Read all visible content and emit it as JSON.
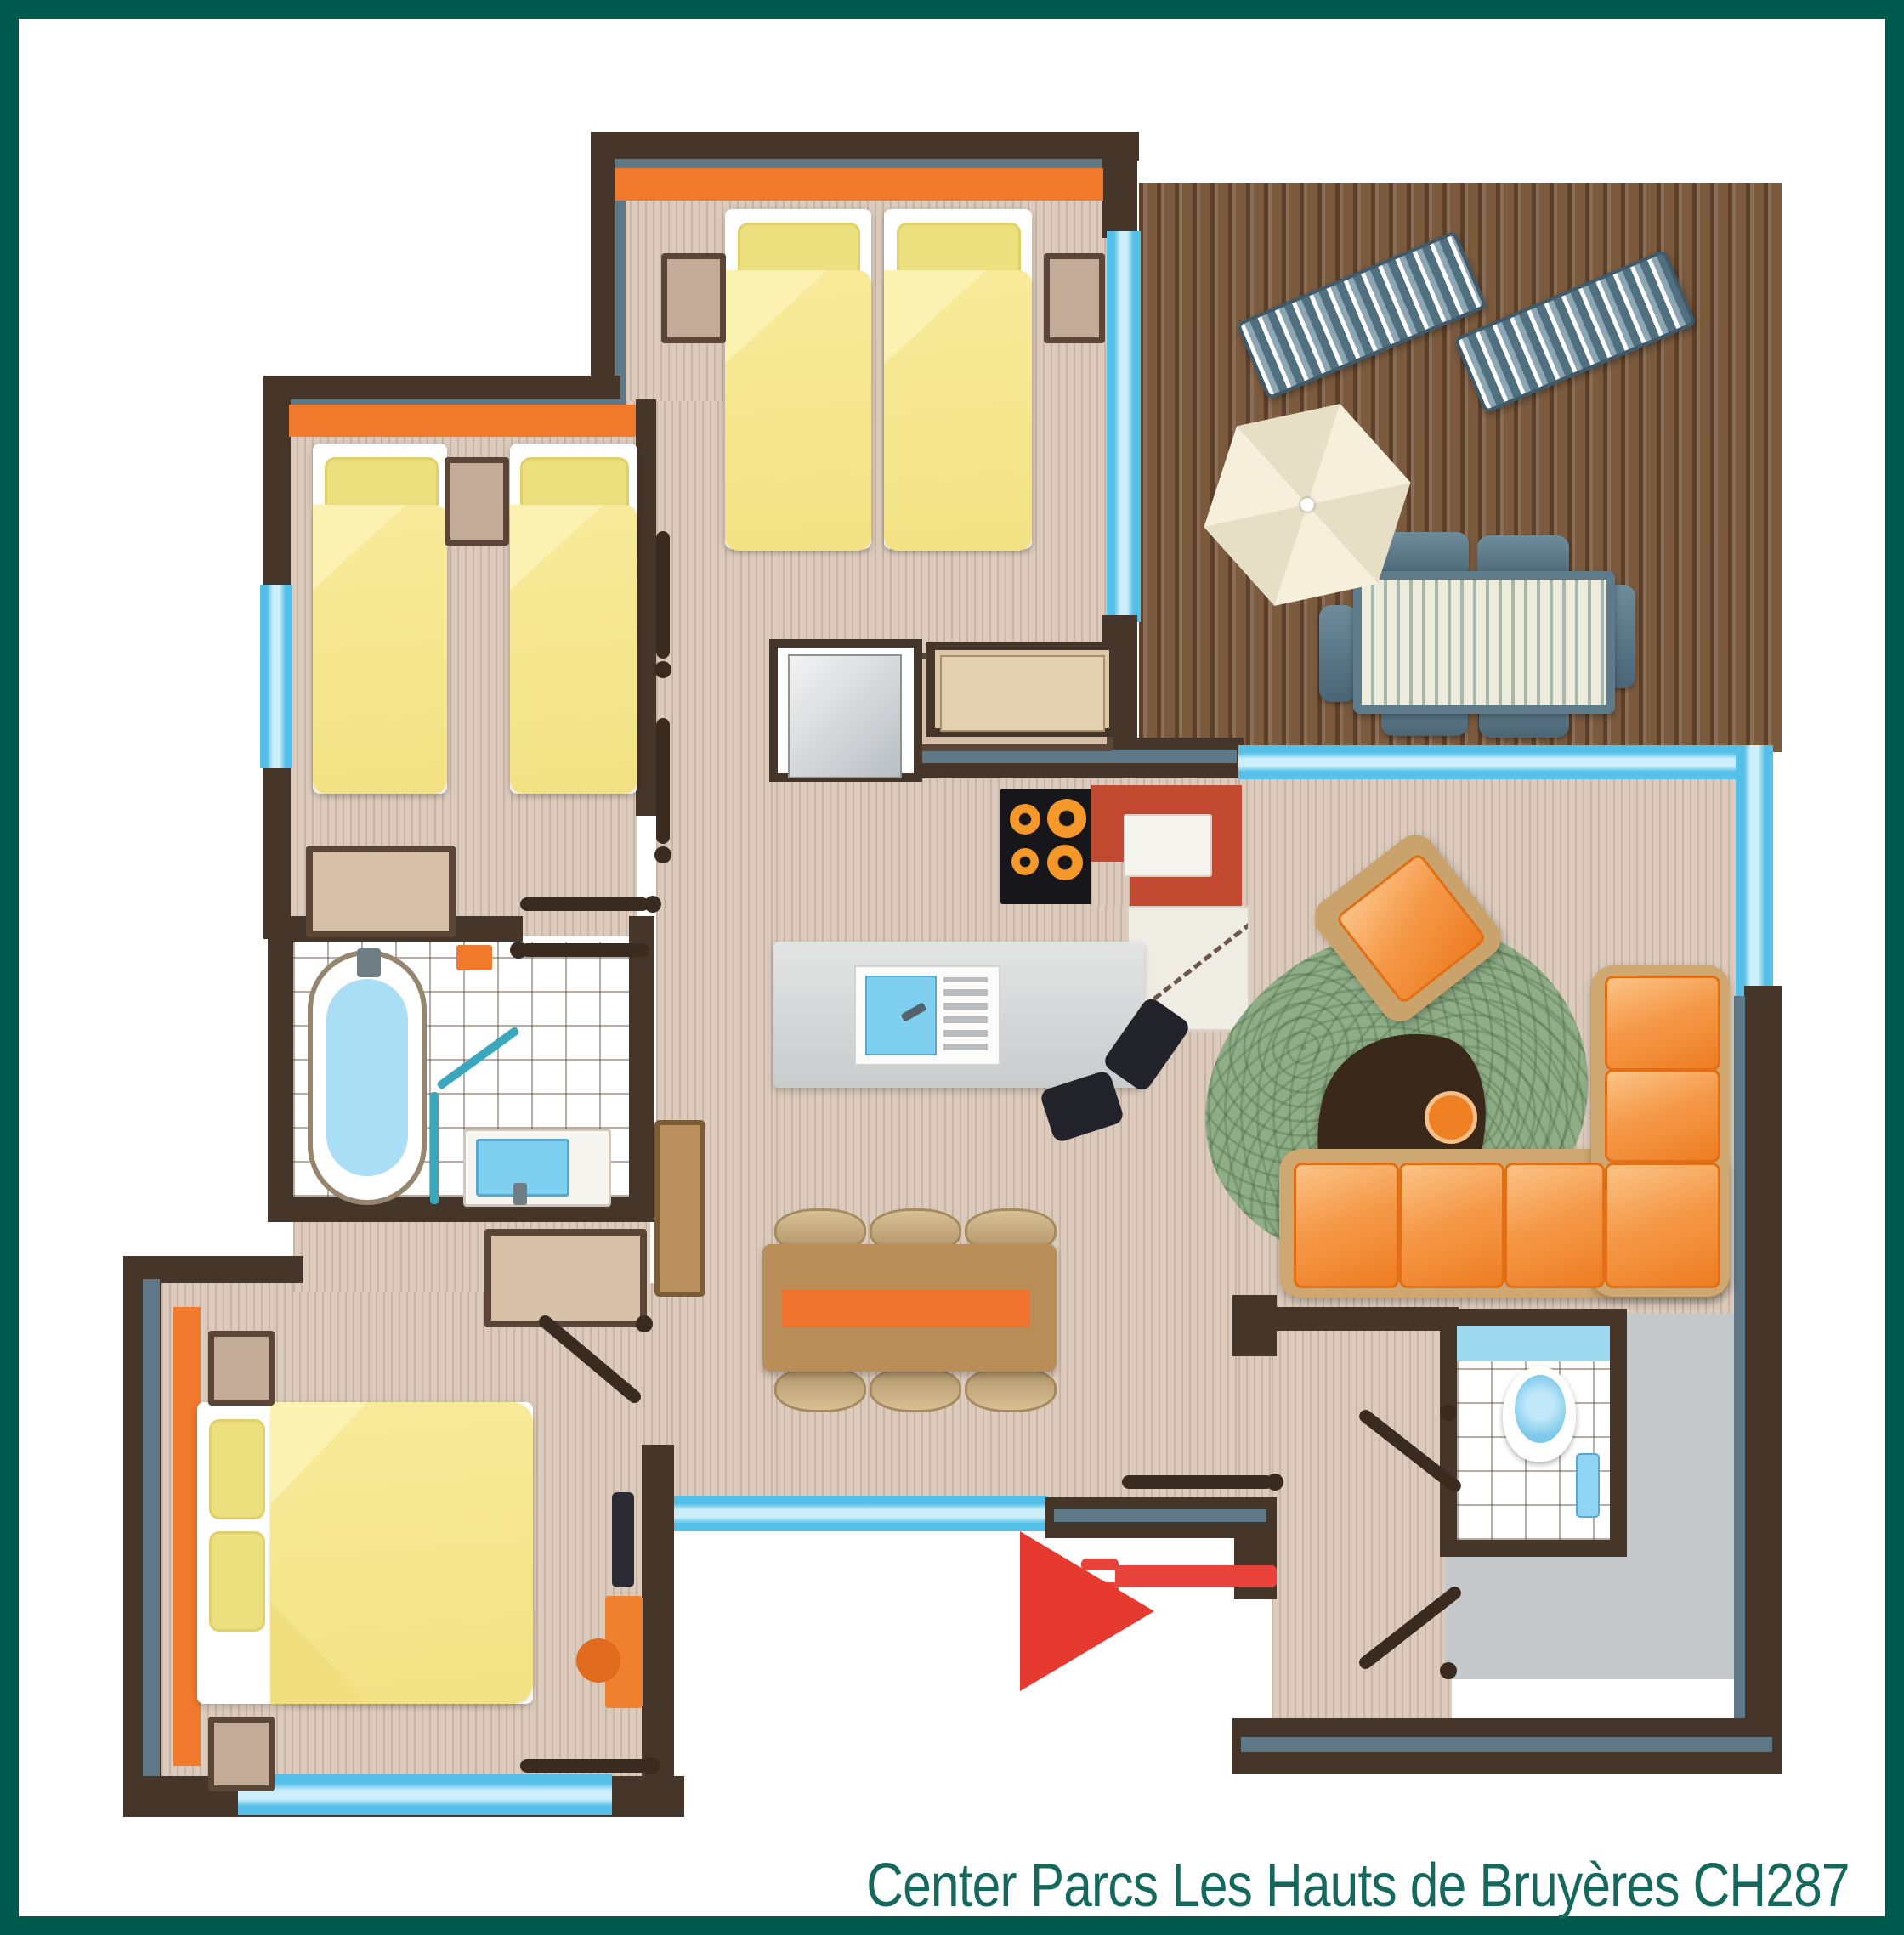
{
  "caption": {
    "text": "Center Parcs Les Hauts de Bruyères CH287"
  },
  "palette": {
    "frame": "#00594d",
    "caption_text": "#17685c",
    "wall": "#463529",
    "wall_accent": "#5f7887",
    "floor": "#dccbbc",
    "deck": "#7b5a3e",
    "window_blue": "#62c8ee",
    "accent_orange": "#f0792b",
    "bed_yellow": "#f6e78c",
    "sofa_orange": "#ee7d22",
    "rug_green": "#8fae87",
    "arrow_red": "#e63930",
    "door_red": "#e8433b",
    "tile_white": "#ffffff",
    "storage_gray": "#c5c8ca",
    "water_blue": "#a9def4",
    "furniture_tan": "#c2ab97",
    "table_wood": "#b98d57",
    "patio_slate": "#5d7b8a"
  }
}
